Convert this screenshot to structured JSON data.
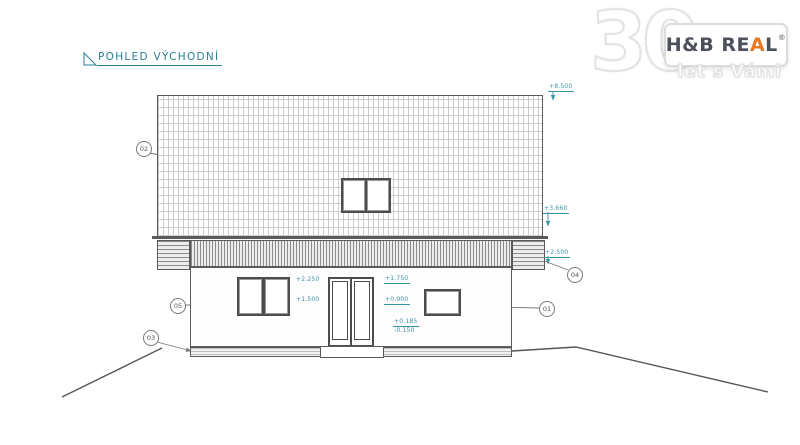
{
  "drawing": {
    "title": "POHLED VÝCHODNÍ",
    "accent_teal": "#3b93a7",
    "line_color": "#5a5a5a",
    "levels": {
      "ridge": "+8.500",
      "roof_mid": "+3.660",
      "eaves": "+2.500",
      "window_head": "+2.250",
      "window_sill": "+1.500",
      "small_window_head": "+1.750",
      "small_window_sill": "+0.900",
      "floor": "+0.185",
      "terrain": "-0.150"
    },
    "callouts": {
      "wall": "01",
      "roof": "02",
      "plinth": "03",
      "eaves": "04",
      "facade": "05"
    }
  },
  "logo": {
    "number": "30",
    "brand_prefix": "H&B RE",
    "brand_accent": "A",
    "brand_suffix": "L",
    "registered": "®",
    "tagline": "let s Vámi",
    "accent_orange": "#e87722"
  }
}
